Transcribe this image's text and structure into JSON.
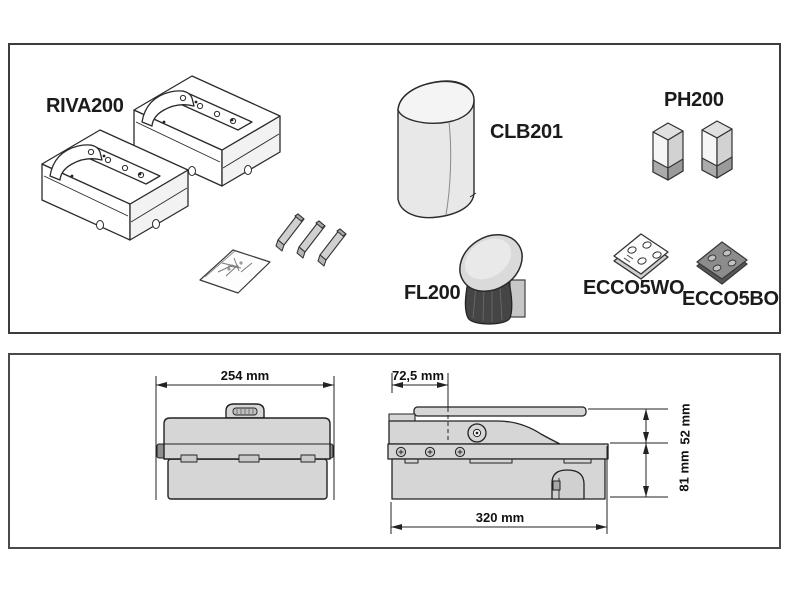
{
  "products_panel": {
    "labels": {
      "riva200": "RIVA200",
      "clb201": "CLB201",
      "ph200": "PH200",
      "fl200": "FL200",
      "ecco5wo": "ECCO5WO",
      "ecco5bo": "ECCO5BO"
    }
  },
  "dimensions_panel": {
    "front_view": {
      "width": "254 mm"
    },
    "side_view": {
      "pivot_offset": "72,5 mm",
      "upper_height": "52 mm",
      "lower_height": "81 mm",
      "length": "320 mm"
    }
  },
  "colors": {
    "outline": "#2b2b2b",
    "panel_border": "#3c3c3c",
    "body_gray": "#d6d6d6",
    "light_face": "#f4f4f4",
    "mid_gray": "#ababab",
    "dark_gray": "#454545",
    "background": "#ffffff"
  }
}
